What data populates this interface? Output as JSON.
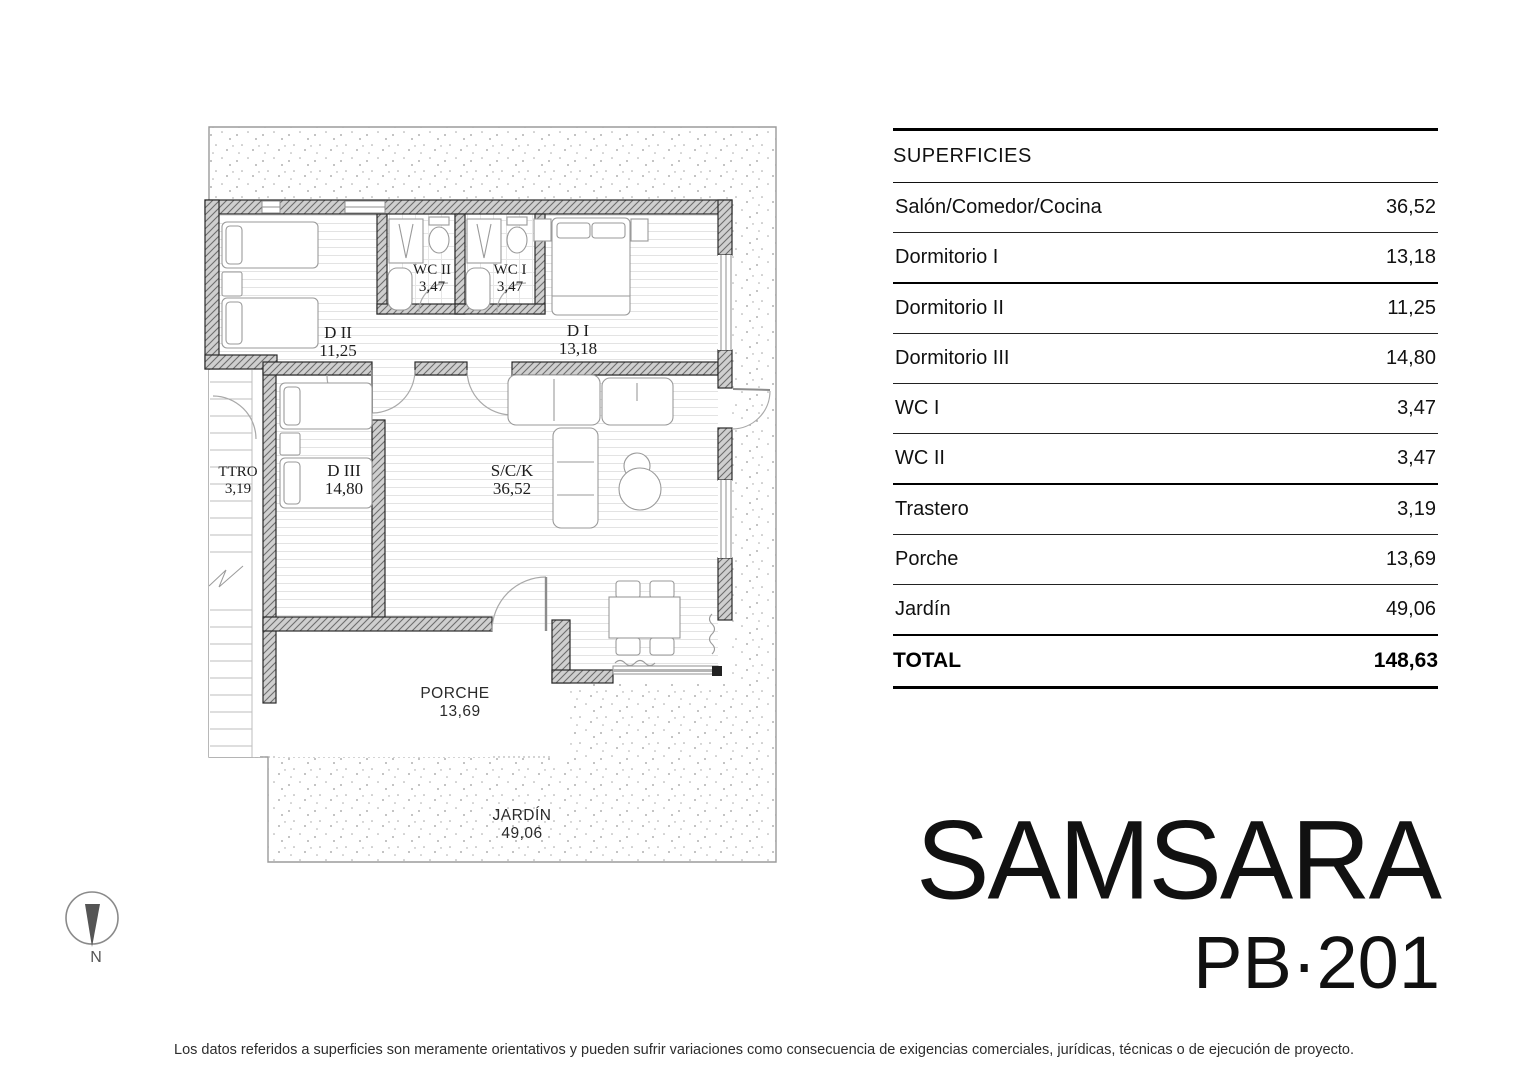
{
  "branding": {
    "project_name": "SAMSARA",
    "unit_code": "PB·201"
  },
  "surfaces_table": {
    "header": "SUPERFICIES",
    "rows": [
      {
        "label": "Salón/Comedor/Cocina",
        "value": "36,52"
      },
      {
        "label": "Dormitorio I",
        "value": "13,18"
      },
      {
        "label": "Dormitorio II",
        "value": "11,25"
      },
      {
        "label": "Dormitorio III",
        "value": "14,80"
      },
      {
        "label": "WC I",
        "value": "3,47"
      },
      {
        "label": "WC II",
        "value": "3,47"
      },
      {
        "label": "Trastero",
        "value": "3,19"
      },
      {
        "label": "Porche",
        "value": "13,69"
      },
      {
        "label": "Jardín",
        "value": "49,06"
      }
    ],
    "total": {
      "label": "TOTAL",
      "value": "148,63"
    }
  },
  "floor_plan": {
    "rooms": [
      {
        "id": "dormitorio-2",
        "label": "D II",
        "area": "11,25"
      },
      {
        "id": "wc-2",
        "label": "WC II",
        "area": "3,47"
      },
      {
        "id": "wc-1",
        "label": "WC I",
        "area": "3,47"
      },
      {
        "id": "dormitorio-1",
        "label": "D I",
        "area": "13,18"
      },
      {
        "id": "trastero",
        "label": "TTRO",
        "area": "3,19"
      },
      {
        "id": "dormitorio-3",
        "label": "D III",
        "area": "14,80"
      },
      {
        "id": "salon-comedor-cocina",
        "label": "S/C/K",
        "area": "36,52"
      },
      {
        "id": "porche",
        "label": "PORCHE",
        "area": "13,69"
      },
      {
        "id": "jardin",
        "label": "JARDÍN",
        "area": "49,06"
      }
    ],
    "compass": {
      "label": "N"
    }
  },
  "document": {
    "disclaimer": "Los datos referidos a superficies son meramente orientativos y pueden sufrir variaciones como consecuencia de exigencias comerciales, jurídicas, técnicas o de ejecución de proyecto."
  },
  "colors": {
    "wall_fill": "#cfcfcf",
    "wall_line": "#2a2a2a",
    "stipple_dot": "#9a9a9a",
    "floor_line": "#e3e3e3",
    "text": "#111111"
  }
}
